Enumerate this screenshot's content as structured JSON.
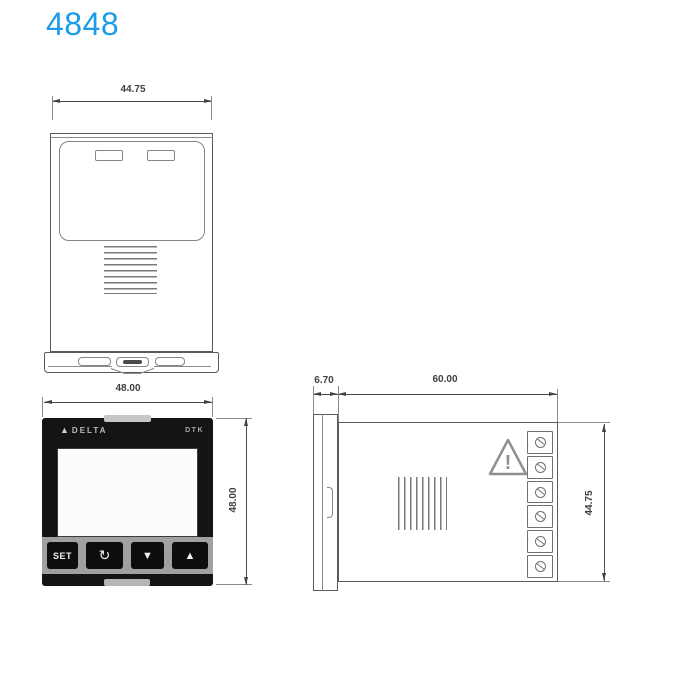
{
  "page": {
    "title": "4848"
  },
  "colors": {
    "title": "#1b9be9",
    "line": "#5a5a5a",
    "panel_black": "#141414",
    "strip_gray": "#a0a0a0"
  },
  "top_view": {
    "width_dim": "44.75"
  },
  "front_view": {
    "width_dim": "48.00",
    "height_dim": "48.00",
    "brand": "DELTA",
    "logo_icon": "delta-triangle-icon",
    "model": "DTK",
    "buttons": [
      {
        "name": "set",
        "glyph": "SET"
      },
      {
        "name": "loop",
        "glyph": "↻"
      },
      {
        "name": "down",
        "glyph": "▼"
      },
      {
        "name": "up",
        "glyph": "▲"
      }
    ]
  },
  "side_view": {
    "bezel_depth_dim": "6.70",
    "body_depth_dim": "60.00",
    "height_dim": "44.75",
    "terminal_count": 6,
    "warning_mark": "!"
  }
}
